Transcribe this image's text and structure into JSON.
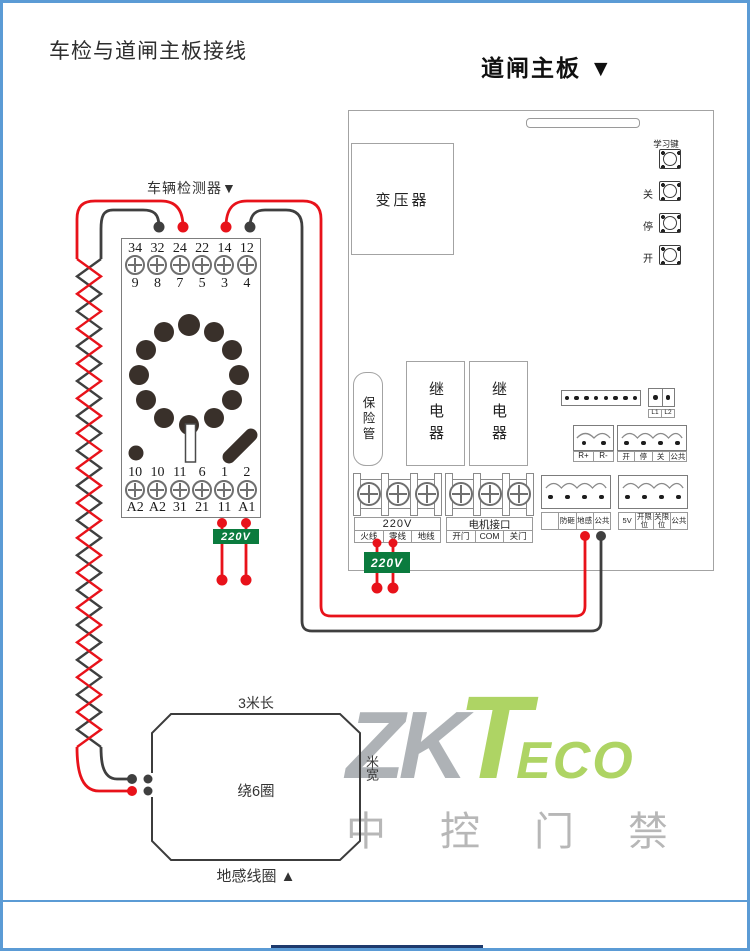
{
  "page": {
    "title": "车检与道闸主板接线"
  },
  "board": {
    "title": "道闸主板 ▼",
    "transformer_label": "变压器",
    "fuse_label": "保险管",
    "relay1_label": "继电器",
    "relay2_label": "继电器",
    "buttons": {
      "learn": "学习键",
      "close": "关",
      "stop": "停",
      "open": "开"
    },
    "power_terminal": {
      "title": "220V",
      "cells": [
        "火线",
        "零线",
        "地线"
      ]
    },
    "motor_terminal": {
      "title": "电机接口",
      "cells": [
        "开门",
        "COM",
        "关门"
      ]
    },
    "l1l2_labels": [
      "L1",
      "L2"
    ],
    "remote_labels": [
      "R+",
      "R-"
    ],
    "control_labels": [
      "开",
      "停",
      "关",
      "公共"
    ],
    "sensor_labels": [
      "",
      "防砸",
      "地感",
      "公共"
    ],
    "limit_labels": [
      "5V",
      "开限位",
      "关限位",
      "公共"
    ],
    "power_tag": "220V"
  },
  "detector": {
    "title": "车辆检测器▼",
    "top_numbers": [
      "34",
      "32",
      "24",
      "22",
      "14",
      "12"
    ],
    "top_pins": [
      "9",
      "8",
      "7",
      "5",
      "3",
      "4"
    ],
    "bottom_numbers": [
      "10",
      "10",
      "11",
      "6",
      "1",
      "2"
    ],
    "bottom_pins": [
      "A2",
      "A2",
      "31",
      "21",
      "11",
      "A1"
    ],
    "power_tag": "220V"
  },
  "coil": {
    "length_label": "3米长",
    "turns_label": "绕6圈",
    "name_label": "地感线圈 ▲",
    "width_label": "米宽"
  },
  "watermark": {
    "zk": "ZK",
    "t": "T",
    "eco": "ECO",
    "cn": [
      "中",
      "控",
      "门",
      "禁"
    ]
  },
  "colors": {
    "wire_red": "#e8121a",
    "wire_dark": "#3f3f3f",
    "tag_green": "#0b7b3e",
    "border_blue": "#5b9bd5",
    "footer_navy": "#1e3a6d",
    "watermark_green": "#9bca3e",
    "watermark_gray": "#9aa0a4"
  }
}
